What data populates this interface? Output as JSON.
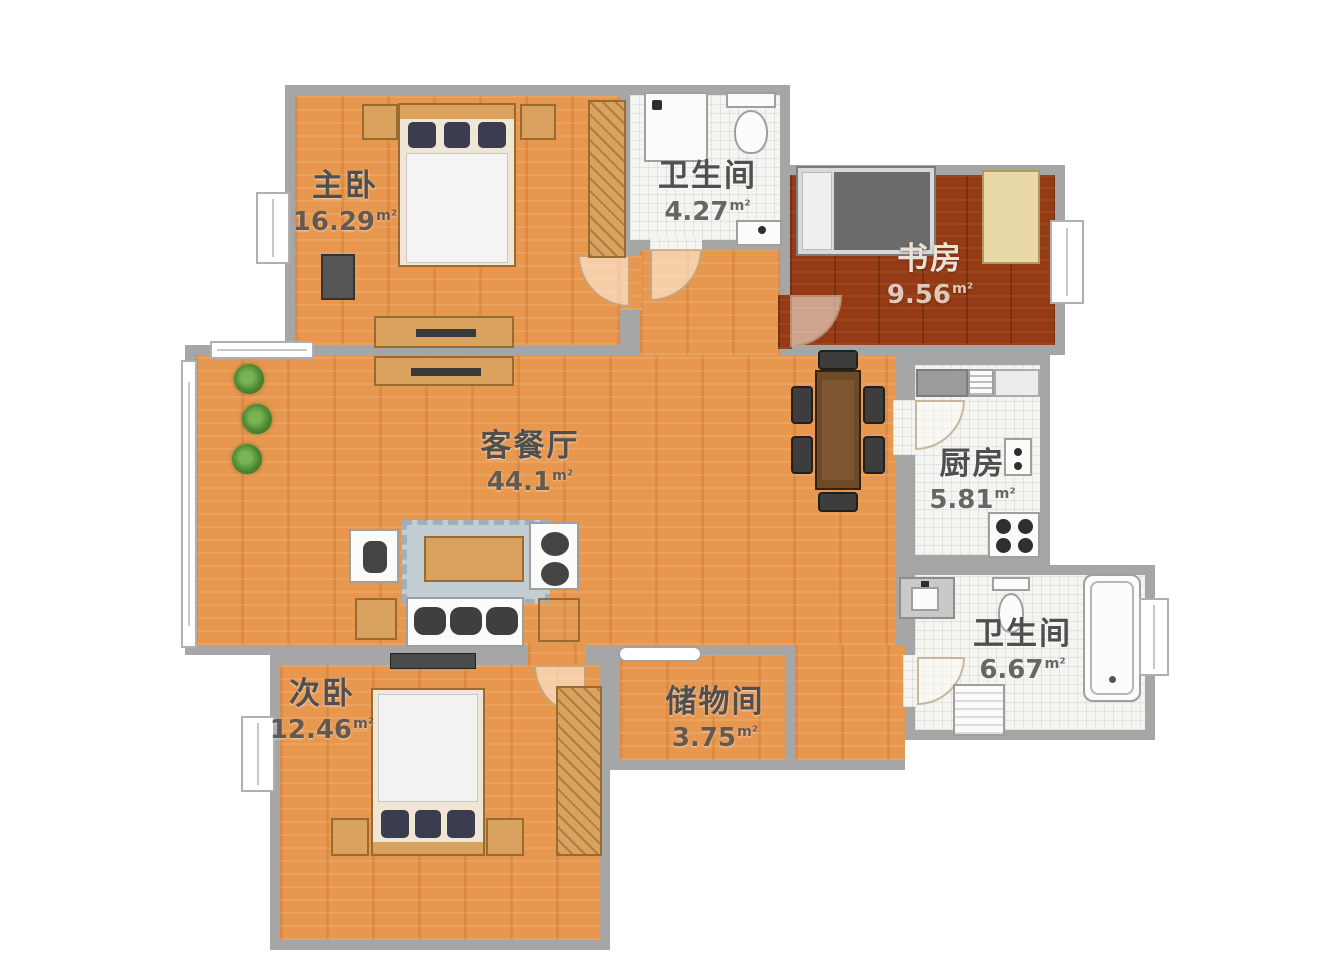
{
  "plan": {
    "unit": "m²",
    "rooms": [
      {
        "id": "master-bedroom",
        "name": "主卧",
        "area": "16.29"
      },
      {
        "id": "bath-top",
        "name": "卫生间",
        "area": "4.27"
      },
      {
        "id": "study",
        "name": "书房",
        "area": "9.56"
      },
      {
        "id": "living-dining",
        "name": "客餐厅",
        "area": "44.1"
      },
      {
        "id": "kitchen",
        "name": "厨房",
        "area": "5.81"
      },
      {
        "id": "bath-bottom",
        "name": "卫生间",
        "area": "6.67"
      },
      {
        "id": "second-bedroom",
        "name": "次卧",
        "area": "12.46"
      },
      {
        "id": "storage",
        "name": "储物间",
        "area": "3.75"
      }
    ]
  },
  "palette": {
    "wall": "#a6a6a6",
    "wood": "#e8974e",
    "study": "#943a14",
    "tile": "#f4f4f1",
    "tan": "#d9a25e",
    "tan-border": "#9a6b2e",
    "label": "#4f4f4f",
    "dark-furniture": "#3d3d3d",
    "white-furniture": "#fbfbfa",
    "plant": "#4e8a33",
    "rug": "#c3cdd4"
  }
}
